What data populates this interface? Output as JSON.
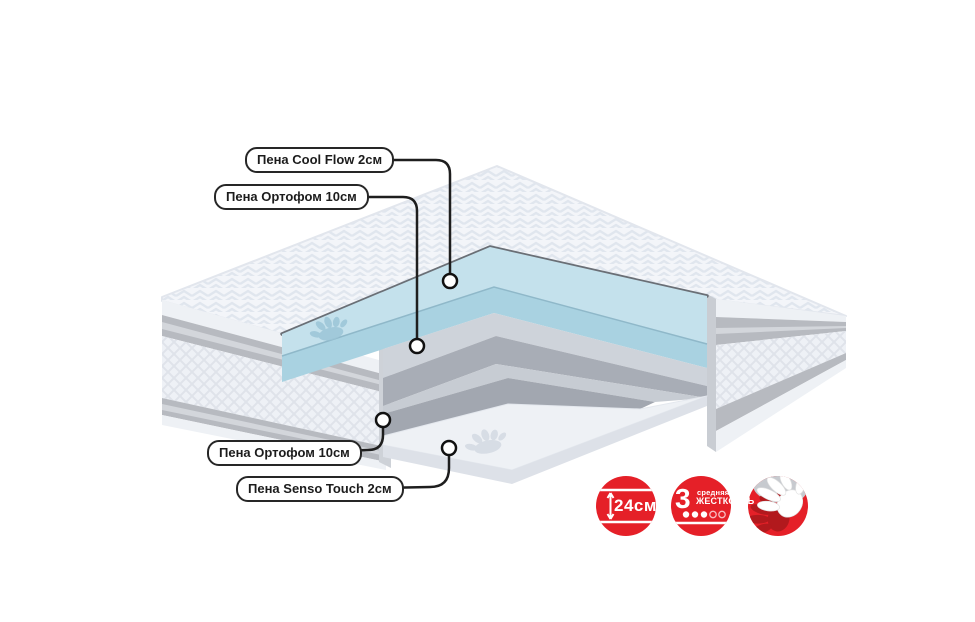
{
  "diagram": {
    "title": "mattress-layers-cutaway",
    "callouts": [
      {
        "id": "cool-flow",
        "label": "Пена Cool Flow 2см"
      },
      {
        "id": "ortofoam-top",
        "label": "Пена Ортофом 10см"
      },
      {
        "id": "ortofoam-bottom",
        "label": "Пена Ортофом 10см"
      },
      {
        "id": "senso-touch",
        "label": "Пена Senso Touch 2см"
      }
    ],
    "layers": [
      {
        "name": "Пена Cool Flow 2см",
        "color": "#c4e1ec"
      },
      {
        "name": "Пена Ортофом 10см",
        "color": "#ced3da"
      },
      {
        "name": "Пена Ортофом 10см",
        "color": "#c7ccd3"
      },
      {
        "name": "Пена Senso Touch 2см",
        "color": "#eef1f5"
      }
    ],
    "badges": {
      "height": {
        "value": "24см",
        "icon": "vertical-arrow-icon"
      },
      "firmness": {
        "number": "3",
        "word_top": "средняя",
        "word_bottom": "жесткость",
        "filled": 3,
        "total": 5
      },
      "comfort": {
        "icon": "hands-icon"
      }
    },
    "colors": {
      "accent_red": "#e52028",
      "dark_red_hand": "#b2191d",
      "cover": "#f3f5f9",
      "piping": "#6a6f76"
    }
  }
}
